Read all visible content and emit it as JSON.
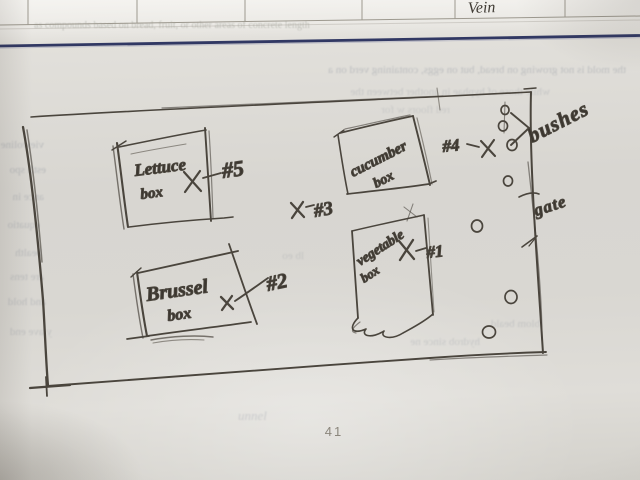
{
  "photo": {
    "page_number": "41",
    "paper_color": "#d9d7d2",
    "pencil_color": "#4a453d",
    "ink_line_color": "#313863"
  },
  "top_table": {
    "cell_label": "Vein"
  },
  "garden_sketch": {
    "plot_boxes": [
      {
        "name": "lettuce-box",
        "line1": "Lettuce",
        "line2": "box",
        "tag": "#5"
      },
      {
        "name": "cucumber-box",
        "line1": "cucumber",
        "line2": "box",
        "tag": "#3"
      },
      {
        "name": "vegetable-box",
        "line1": "vegetable",
        "line2": "box",
        "tag": "#1"
      },
      {
        "name": "brussel-box",
        "line1": "Brussel",
        "line2": "box",
        "tag": "#2"
      }
    ],
    "markers": {
      "tag4": "#4",
      "bushes_label": "bushes",
      "gate_label": "gate"
    }
  },
  "bleedthrough": [
    {
      "text": "as compounds based on bread, fruit, or other areas of concrete length"
    },
    {
      "text": "the mold is not growing on bread, but on eggs, containing verd on a"
    },
    {
      "text": "while those of hyphae in another between the"
    },
    {
      "text": "viewoline"
    },
    {
      "text": "estli spo"
    },
    {
      "text": "ance in"
    },
    {
      "text": "equatio"
    },
    {
      "text": "bealth"
    },
    {
      "text": "are tens"
    },
    {
      "text": "and hold"
    },
    {
      "text": "y ave end"
    },
    {
      "text": "hydrob since ne"
    },
    {
      "text": "blom beald"
    },
    {
      "text": "unnel"
    },
    {
      "text": "red floors w for"
    },
    {
      "text": "lb eo"
    }
  ]
}
